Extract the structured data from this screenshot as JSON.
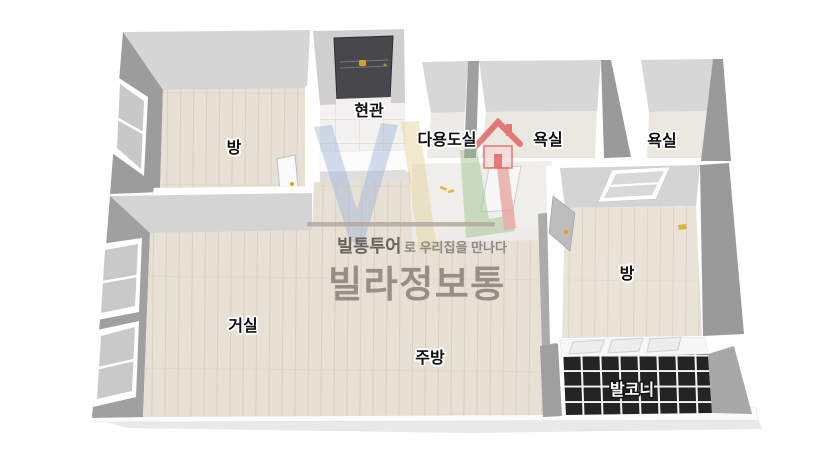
{
  "scene": {
    "type": "3d-floor-plan-rendering",
    "language": "ko"
  },
  "rooms": [
    {
      "id": "bedroom-top-left",
      "label": "방"
    },
    {
      "id": "entrance",
      "label": "현관"
    },
    {
      "id": "utility-room",
      "label": "다용도실"
    },
    {
      "id": "bathroom-1",
      "label": "욕실"
    },
    {
      "id": "bathroom-2",
      "label": "욕실"
    },
    {
      "id": "bedroom-right",
      "label": "방"
    },
    {
      "id": "living-room",
      "label": "거실"
    },
    {
      "id": "kitchen",
      "label": "주방"
    },
    {
      "id": "balcony",
      "label": "발코니"
    }
  ],
  "watermark": {
    "tagline_brand": "빌통투어",
    "tagline_rest": "로 우리집을 만나다",
    "brand": "빌라정보통",
    "logo_icon": "house-icon"
  },
  "colors": {
    "background": "#ffffff",
    "floor_wood": "#e7e0d4",
    "floor_wood_light": "#ebe5da",
    "floor_entrance_tile": "#f3f2f0",
    "floor_bathroom": "#ebe8e2",
    "wall_back": "#d6d6d6",
    "wall_side": "#9e9e9e",
    "wall_white": "#ffffff",
    "balcony_tile": "#242424",
    "balcony_grout": "#f5f5f5",
    "entrance_door": "#48484c",
    "door_handle_gold": "#d8a21e",
    "ground_shadow": "#e9e9e9",
    "label_text": "#0e0e0e",
    "label_halo": "#ffffff",
    "balcony_label_text": "#ffffff",
    "balcony_label_halo": "#161616",
    "watermark_divider": "#b2a9a0",
    "watermark_text": "#666460",
    "watermark_text_light": "#8d8a86",
    "brand_text": "#978f87",
    "logo_blue": "#9db3d6",
    "logo_yellow": "#e5d194",
    "logo_green": "#9cc089",
    "logo_red": "#dd6b63",
    "logo_house_red": "#e05252"
  }
}
